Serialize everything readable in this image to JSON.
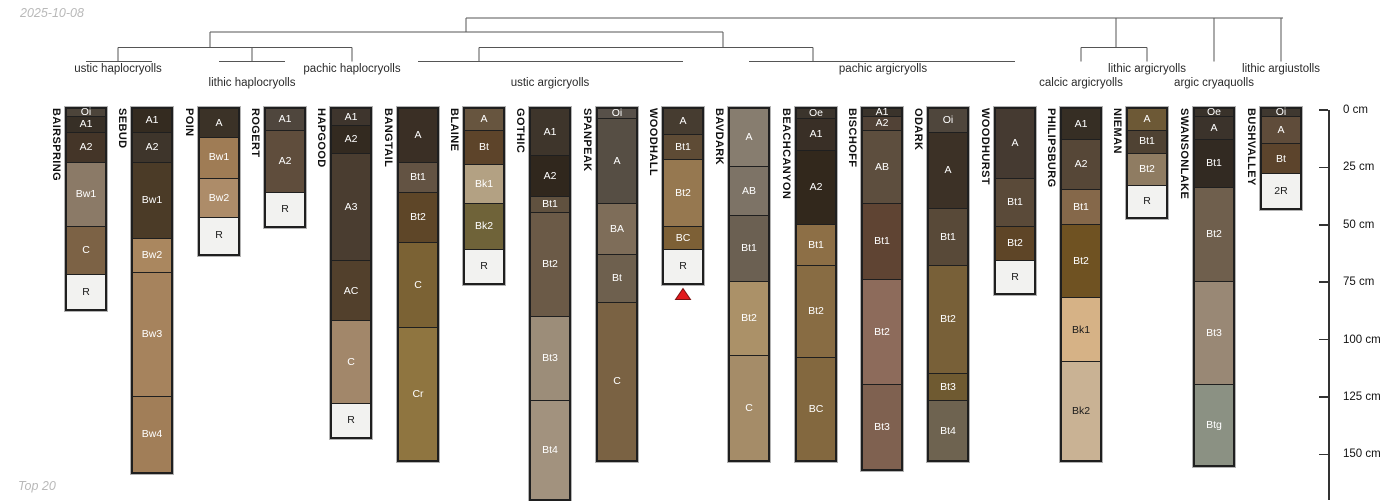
{
  "page": {
    "date_stamp": "2025-10-08",
    "footer_note": "Top 20"
  },
  "chart_data": {
    "type": "bar",
    "subtype": "soil-profile depth columns (stacked horizons) grouped by taxonomy dendrogram",
    "title": "",
    "depth_axis": {
      "unit": "cm",
      "side": "right",
      "ticks": [
        0,
        25,
        50,
        75,
        100,
        125,
        150
      ],
      "max_visible_cm": 170,
      "grid": false
    },
    "dendrogram": {
      "line_color": "#555555",
      "taxa": [
        {
          "label": "ustic haplocryolls",
          "cx": 118,
          "row": 1
        },
        {
          "label": "lithic haplocryolls",
          "cx": 252,
          "row": 2
        },
        {
          "label": "pachic haplocryolls",
          "cx": 352,
          "row": 1
        },
        {
          "label": "ustic argicryolls",
          "cx": 550,
          "row": 2
        },
        {
          "label": "pachic argicryolls",
          "cx": 883,
          "row": 1
        },
        {
          "label": "calcic argicryolls",
          "cx": 1081,
          "row": 2
        },
        {
          "label": "lithic argicryolls",
          "cx": 1147,
          "row": 1
        },
        {
          "label": "argic cryaquolls",
          "cx": 1214,
          "row": 2
        },
        {
          "label": "lithic argiustolls",
          "cx": 1281,
          "row": 1
        }
      ]
    },
    "marker": {
      "shape": "triangle-up",
      "fill": "#e3191c",
      "stroke": "#7a1010",
      "at_profile": "WOODHALL"
    },
    "profiles": [
      {
        "name": "BAIRSPRING",
        "cx": 86,
        "marker": false,
        "horizons": [
          {
            "label": "Oi",
            "top": 0,
            "bottom": 3,
            "color": "#4c443a"
          },
          {
            "label": "A1",
            "top": 3,
            "bottom": 10,
            "color": "#372f26"
          },
          {
            "label": "A2",
            "top": 10,
            "bottom": 23,
            "color": "#443528"
          },
          {
            "label": "Bw1",
            "top": 23,
            "bottom": 51,
            "color": "#8b7a67"
          },
          {
            "label": "C",
            "top": 51,
            "bottom": 72,
            "color": "#7c6245"
          },
          {
            "label": "R",
            "top": 72,
            "bottom": 87,
            "color": "#f2f2f0"
          }
        ]
      },
      {
        "name": "SEBUD",
        "cx": 152,
        "marker": false,
        "horizons": [
          {
            "label": "A1",
            "top": 0,
            "bottom": 10,
            "color": "#342b20"
          },
          {
            "label": "A2",
            "top": 10,
            "bottom": 23,
            "color": "#3e352b"
          },
          {
            "label": "Bw1",
            "top": 23,
            "bottom": 56,
            "color": "#4b3b27"
          },
          {
            "label": "Bw2",
            "top": 56,
            "bottom": 71,
            "color": "#aa875f"
          },
          {
            "label": "Bw3",
            "top": 71,
            "bottom": 125,
            "color": "#a6835d"
          },
          {
            "label": "Bw4",
            "top": 125,
            "bottom": 158,
            "color": "#a17e58"
          }
        ]
      },
      {
        "name": "POIN",
        "cx": 219,
        "marker": false,
        "horizons": [
          {
            "label": "A",
            "top": 0,
            "bottom": 12,
            "color": "#3b3227"
          },
          {
            "label": "Bw1",
            "top": 12,
            "bottom": 30,
            "color": "#9f7c55"
          },
          {
            "label": "Bw2",
            "top": 30,
            "bottom": 47,
            "color": "#ad8c69"
          },
          {
            "label": "R",
            "top": 47,
            "bottom": 63,
            "color": "#f2f2f0"
          }
        ]
      },
      {
        "name": "ROGERT",
        "cx": 285,
        "marker": false,
        "horizons": [
          {
            "label": "A1",
            "top": 0,
            "bottom": 9,
            "color": "#4f463d"
          },
          {
            "label": "A2",
            "top": 9,
            "bottom": 36,
            "color": "#5f4d3c"
          },
          {
            "label": "R",
            "top": 36,
            "bottom": 51,
            "color": "#f2f2f0"
          }
        ]
      },
      {
        "name": "HAPGOOD",
        "cx": 351,
        "marker": false,
        "horizons": [
          {
            "label": "A1",
            "top": 0,
            "bottom": 7,
            "color": "#3e352d"
          },
          {
            "label": "A2",
            "top": 7,
            "bottom": 19,
            "color": "#332a20"
          },
          {
            "label": "A3",
            "top": 19,
            "bottom": 66,
            "color": "#4a3d30"
          },
          {
            "label": "AC",
            "top": 66,
            "bottom": 92,
            "color": "#52402c"
          },
          {
            "label": "C",
            "top": 92,
            "bottom": 128,
            "color": "#a2876a"
          },
          {
            "label": "R",
            "top": 128,
            "bottom": 143,
            "color": "#f2f2f0"
          }
        ]
      },
      {
        "name": "BANGTAIL",
        "cx": 418,
        "marker": false,
        "horizons": [
          {
            "label": "A",
            "top": 0,
            "bottom": 23,
            "color": "#3a2f25"
          },
          {
            "label": "Bt1",
            "top": 23,
            "bottom": 36,
            "color": "#635343"
          },
          {
            "label": "Bt2",
            "top": 36,
            "bottom": 58,
            "color": "#5e4628"
          },
          {
            "label": "C",
            "top": 58,
            "bottom": 95,
            "color": "#7b6234"
          },
          {
            "label": "Cr",
            "top": 95,
            "bottom": 153,
            "color": "#8f7540"
          }
        ]
      },
      {
        "name": "BLAINE",
        "cx": 484,
        "marker": false,
        "horizons": [
          {
            "label": "A",
            "top": 0,
            "bottom": 9,
            "color": "#67553f"
          },
          {
            "label": "Bt",
            "top": 9,
            "bottom": 24,
            "color": "#5d442a"
          },
          {
            "label": "Bk1",
            "top": 24,
            "bottom": 41,
            "color": "#b3a183"
          },
          {
            "label": "Bk2",
            "top": 41,
            "bottom": 61,
            "color": "#6f6339"
          },
          {
            "label": "R",
            "top": 61,
            "bottom": 76,
            "color": "#f2f2f0"
          }
        ]
      },
      {
        "name": "GOTHIC",
        "cx": 550,
        "marker": false,
        "horizons": [
          {
            "label": "A1",
            "top": 0,
            "bottom": 20,
            "color": "#3e352b"
          },
          {
            "label": "A2",
            "top": 20,
            "bottom": 38,
            "color": "#30271d"
          },
          {
            "label": "Bt1",
            "top": 38,
            "bottom": 45,
            "color": "#60513f"
          },
          {
            "label": "Bt2",
            "top": 45,
            "bottom": 90,
            "color": "#6b5a47"
          },
          {
            "label": "Bt3",
            "top": 90,
            "bottom": 127,
            "color": "#9c8d79"
          },
          {
            "label": "Bt4",
            "top": 127,
            "bottom": 170,
            "color": "#a2927e"
          }
        ]
      },
      {
        "name": "SPANPEAK",
        "cx": 617,
        "marker": false,
        "horizons": [
          {
            "label": "Oi",
            "top": 0,
            "bottom": 4,
            "color": "#575049"
          },
          {
            "label": "A",
            "top": 4,
            "bottom": 41,
            "color": "#564e44"
          },
          {
            "label": "BA",
            "top": 41,
            "bottom": 63,
            "color": "#7e6d59"
          },
          {
            "label": "Bt",
            "top": 63,
            "bottom": 84,
            "color": "#6e604e"
          },
          {
            "label": "C",
            "top": 84,
            "bottom": 153,
            "color": "#7a6243"
          }
        ]
      },
      {
        "name": "WOODHALL",
        "cx": 683,
        "marker": true,
        "horizons": [
          {
            "label": "A",
            "top": 0,
            "bottom": 11,
            "color": "#463c30"
          },
          {
            "label": "Bt1",
            "top": 11,
            "bottom": 22,
            "color": "#5e4b35"
          },
          {
            "label": "Bt2",
            "top": 22,
            "bottom": 51,
            "color": "#967850"
          },
          {
            "label": "BC",
            "top": 51,
            "bottom": 61,
            "color": "#7d6036"
          },
          {
            "label": "R",
            "top": 61,
            "bottom": 76,
            "color": "#f2f2f0"
          }
        ]
      },
      {
        "name": "BAVDARK",
        "cx": 749,
        "marker": false,
        "horizons": [
          {
            "label": "A",
            "top": 0,
            "bottom": 25,
            "color": "#877d6f"
          },
          {
            "label": "AB",
            "top": 25,
            "bottom": 46,
            "color": "#7d7366"
          },
          {
            "label": "Bt1",
            "top": 46,
            "bottom": 75,
            "color": "#6b6052"
          },
          {
            "label": "Bt2",
            "top": 75,
            "bottom": 107,
            "color": "#ab9168"
          },
          {
            "label": "C",
            "top": 107,
            "bottom": 153,
            "color": "#a58c68"
          }
        ]
      },
      {
        "name": "BEACHCANYON",
        "cx": 816,
        "marker": false,
        "horizons": [
          {
            "label": "Oe",
            "top": 0,
            "bottom": 4,
            "color": "#3b342c"
          },
          {
            "label": "A1",
            "top": 4,
            "bottom": 18,
            "color": "#392f26"
          },
          {
            "label": "A2",
            "top": 18,
            "bottom": 50,
            "color": "#32281c"
          },
          {
            "label": "Bt1",
            "top": 50,
            "bottom": 68,
            "color": "#8d6f46"
          },
          {
            "label": "Bt2",
            "top": 68,
            "bottom": 108,
            "color": "#886c43"
          },
          {
            "label": "BC",
            "top": 108,
            "bottom": 153,
            "color": "#83683f"
          }
        ]
      },
      {
        "name": "BISCHOFF",
        "cx": 882,
        "marker": false,
        "horizons": [
          {
            "label": "A1",
            "top": 0,
            "bottom": 3,
            "color": "#3a332b"
          },
          {
            "label": "A2",
            "top": 3,
            "bottom": 9,
            "color": "#514236"
          },
          {
            "label": "AB",
            "top": 9,
            "bottom": 41,
            "color": "#5d4e3e"
          },
          {
            "label": "Bt1",
            "top": 41,
            "bottom": 74,
            "color": "#5f4433"
          },
          {
            "label": "Bt2",
            "top": 74,
            "bottom": 120,
            "color": "#8d6b5b"
          },
          {
            "label": "Bt3",
            "top": 120,
            "bottom": 157,
            "color": "#7f6150"
          }
        ]
      },
      {
        "name": "ODARK",
        "cx": 948,
        "marker": false,
        "horizons": [
          {
            "label": "Oi",
            "top": 0,
            "bottom": 10,
            "color": "#4f463c"
          },
          {
            "label": "A",
            "top": 10,
            "bottom": 43,
            "color": "#3c3126"
          },
          {
            "label": "Bt1",
            "top": 43,
            "bottom": 68,
            "color": "#584938"
          },
          {
            "label": "Bt2",
            "top": 68,
            "bottom": 115,
            "color": "#786038"
          },
          {
            "label": "Bt3",
            "top": 115,
            "bottom": 127,
            "color": "#6f5a31"
          },
          {
            "label": "Bt4",
            "top": 127,
            "bottom": 153,
            "color": "#6e6350"
          }
        ]
      },
      {
        "name": "WOODHURST",
        "cx": 1015,
        "marker": false,
        "horizons": [
          {
            "label": "A",
            "top": 0,
            "bottom": 30,
            "color": "#453a31"
          },
          {
            "label": "Bt1",
            "top": 30,
            "bottom": 51,
            "color": "#5a4a39"
          },
          {
            "label": "Bt2",
            "top": 51,
            "bottom": 66,
            "color": "#5e4527"
          },
          {
            "label": "R",
            "top": 66,
            "bottom": 80,
            "color": "#f2f2f0"
          }
        ]
      },
      {
        "name": "PHILIPSBURG",
        "cx": 1081,
        "marker": false,
        "horizons": [
          {
            "label": "A1",
            "top": 0,
            "bottom": 13,
            "color": "#362e24"
          },
          {
            "label": "A2",
            "top": 13,
            "bottom": 35,
            "color": "#564737"
          },
          {
            "label": "Bt1",
            "top": 35,
            "bottom": 50,
            "color": "#85684a"
          },
          {
            "label": "Bt2",
            "top": 50,
            "bottom": 82,
            "color": "#6f5222"
          },
          {
            "label": "Bk1",
            "top": 82,
            "bottom": 110,
            "color": "#d6b286"
          },
          {
            "label": "Bk2",
            "top": 110,
            "bottom": 153,
            "color": "#c9b294"
          }
        ]
      },
      {
        "name": "NIEMAN",
        "cx": 1147,
        "marker": false,
        "horizons": [
          {
            "label": "A",
            "top": 0,
            "bottom": 9,
            "color": "#6d5936"
          },
          {
            "label": "Bt1",
            "top": 9,
            "bottom": 19,
            "color": "#4f4233"
          },
          {
            "label": "Bt2",
            "top": 19,
            "bottom": 33,
            "color": "#8f7c62"
          },
          {
            "label": "R",
            "top": 33,
            "bottom": 47,
            "color": "#f2f2f0"
          }
        ]
      },
      {
        "name": "SWANSONLAKE",
        "cx": 1214,
        "marker": false,
        "horizons": [
          {
            "label": "Oe",
            "top": 0,
            "bottom": 3,
            "color": "#39322a"
          },
          {
            "label": "A",
            "top": 3,
            "bottom": 13,
            "color": "#3b332b"
          },
          {
            "label": "Bt1",
            "top": 13,
            "bottom": 34,
            "color": "#322a22"
          },
          {
            "label": "Bt2",
            "top": 34,
            "bottom": 75,
            "color": "#6f5f4d"
          },
          {
            "label": "Bt3",
            "top": 75,
            "bottom": 120,
            "color": "#998875"
          },
          {
            "label": "Btg",
            "top": 120,
            "bottom": 155,
            "color": "#8b9183"
          }
        ]
      },
      {
        "name": "BUSHVALLEY",
        "cx": 1281,
        "marker": false,
        "horizons": [
          {
            "label": "Oi",
            "top": 0,
            "bottom": 3,
            "color": "#3f3830"
          },
          {
            "label": "A",
            "top": 3,
            "bottom": 15,
            "color": "#5f4c3a"
          },
          {
            "label": "Bt",
            "top": 15,
            "bottom": 28,
            "color": "#5c442c"
          },
          {
            "label": "2R",
            "top": 28,
            "bottom": 43,
            "color": "#f2f2f0"
          }
        ]
      }
    ]
  }
}
